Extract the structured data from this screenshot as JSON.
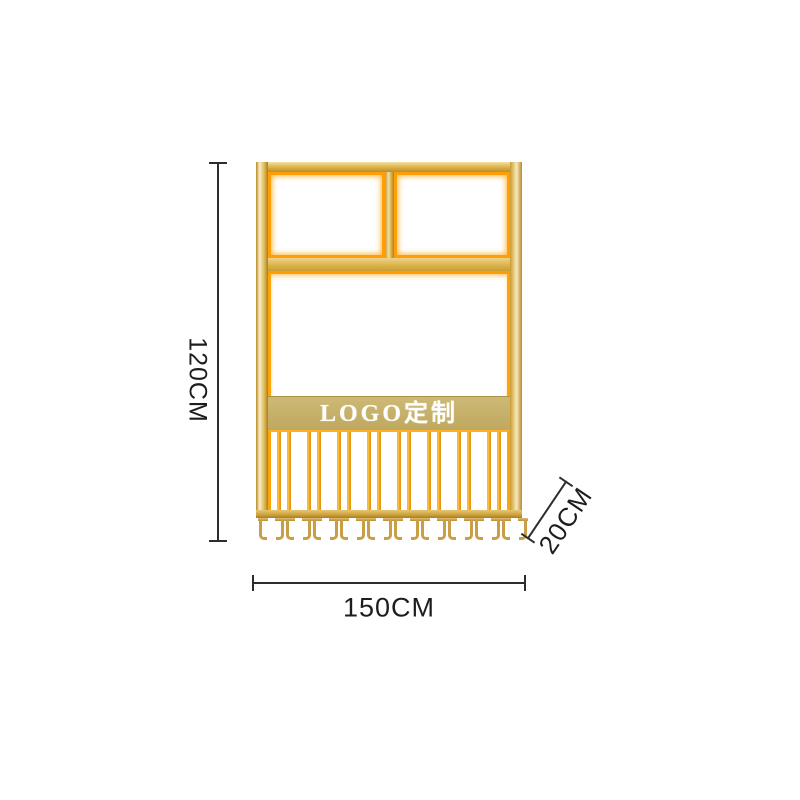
{
  "page": {
    "background_color": "#ffffff"
  },
  "product": {
    "name": "gold wall-mounted wine glass rack",
    "logo_text": "LOGO定制",
    "hook_pairs": 10,
    "colors": {
      "gold_light": "#f8eec9",
      "gold_main": "#ddb44a",
      "gold_dark": "#a87c20",
      "glow_orange": "#ff9e08",
      "logo_band_gold": "#c6b069",
      "logo_text_color": "#ffffff",
      "hook_tan": "#c99e47"
    }
  },
  "dimensions": {
    "height_label": "120CM",
    "width_label": "150CM",
    "depth_label": "20CM",
    "line_color": "#2d2d2d",
    "text_color": "#1d1d1d"
  }
}
